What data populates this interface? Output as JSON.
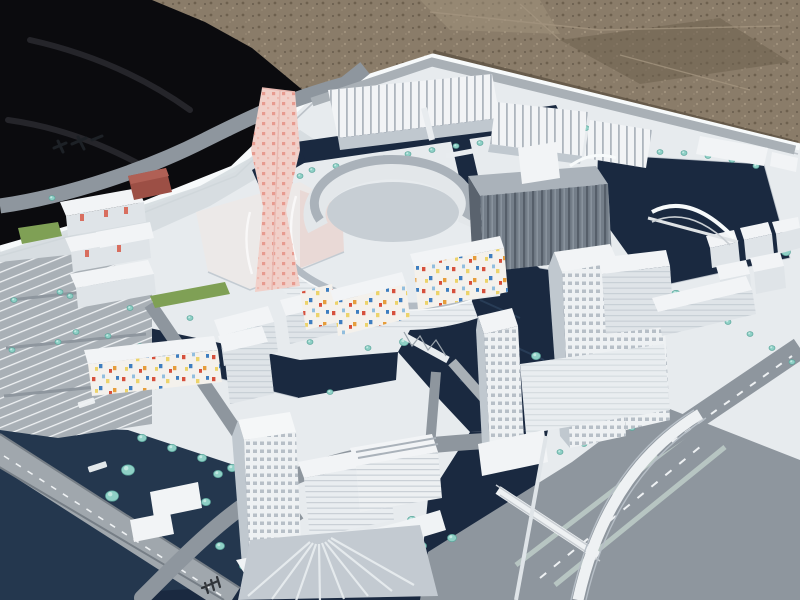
{
  "scene": {
    "type": "photograph",
    "subject": "White architectural scale model of a waterfront urban masterplan district",
    "setting": "Model board photographed outdoors at an oblique angle, lying on gravel ground with a black cloth draped at the top-left corner",
    "notable_features": [
      "pink faceted landmark tower with red dot facade",
      "oval courtyard ring building with multicolored mosaic inner facade",
      "dark navy canals and lake winding through white building blocks",
      "turquoise foam model trees lining canals and streets",
      "cluster of tall gridded office towers on the right island",
      "single tall tower on the south island with radial paved plaza",
      "white arch bridge over the lake and truss footbridges over canals",
      "grey roads with parking lots, lane markings and a wide boulevard with flyover ramp"
    ]
  },
  "annotations": {
    "board_logo": "small dark maker's mark printed on the board, upper left",
    "road_label_1": "illegible white road-name label on asphalt",
    "road_label_2": "illegible white road-name label on asphalt",
    "rail_glyph": "dark transit symbol printed on road, bottom centre"
  },
  "palette": {
    "gravel_base": "#8a7c69",
    "gravel_dark": "#6d604e",
    "gravel_light": "#a2947e",
    "gravel_shadow": "#5e5244",
    "fabric": "#0b0b0e",
    "fabric_hl": "#2c2c32",
    "board": "#e7ebee",
    "board_edge": "#f7fafb",
    "board_shadow": "#d3dade",
    "road": "#8e969e",
    "road_dark": "#767e86",
    "road_light": "#a9b0b6",
    "median": "#b7c5c2",
    "lane": "#eef1f3",
    "water": "#1a2940",
    "water_light": "#24374e",
    "quay": "#cfd6dc",
    "tree": "#8fd0c6",
    "tree_hl": "#c2e8e1",
    "tree_dark": "#5da89d",
    "bldg_top": "#f2f4f6",
    "bldg_face": "#dfe4e8",
    "bldg_shadow": "#c0c8cf",
    "bldg_dark": "#9aa3ab",
    "glass": "#747e89",
    "glass_dark": "#565f6a",
    "roof_gray": "#aab2ba",
    "cream": "#f4f1ec",
    "pink": "#f1d0c9",
    "pink_dot": "#e58d82",
    "pink_face": "#e7cfc9",
    "maroon": "#9c4f45",
    "maroon_top": "#b06055",
    "grass": "#7fa055",
    "mosaic_red": "#d6503c",
    "mosaic_blue": "#3e7ec0",
    "mosaic_orange": "#e69d3c",
    "mosaic_yellow": "#ecd36b",
    "mosaic_sky": "#92bede",
    "glyph_dark": "#1d2126"
  }
}
